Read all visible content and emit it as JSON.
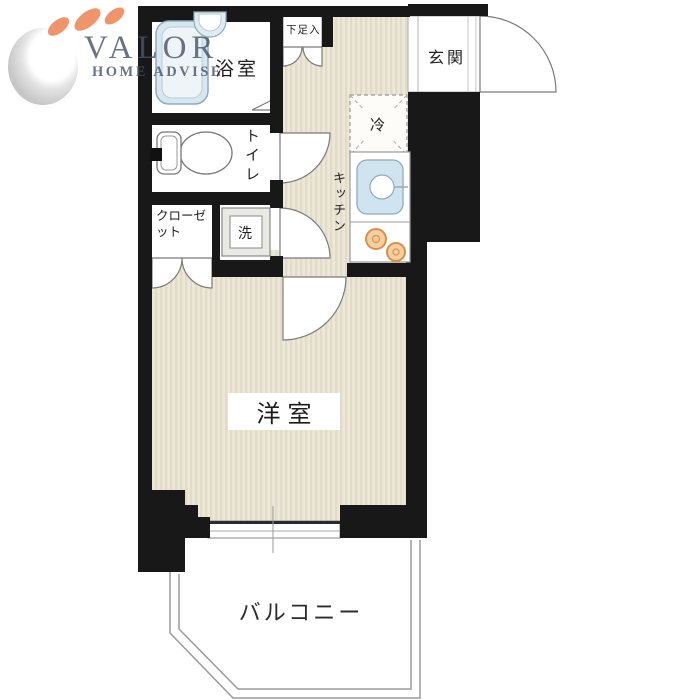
{
  "page": {
    "background": "#ffffff"
  },
  "logo": {
    "title": "VALOR",
    "subtitle": "HOME ADVISE",
    "accent_color": "#ee8b5e",
    "text_color": "#4b5468"
  },
  "floorplan": {
    "wall_color": "#181818",
    "floor_color": "#ece7d7",
    "floor_stripe_color": "#e1dbc8",
    "water_fixture_color": "#cfe4ee",
    "burner_color": "#f6cf9f",
    "labels": {
      "bathroom": "浴室",
      "toilet": "トイレ",
      "closet": "クローゼット",
      "washing_machine": "洗",
      "kitchen": "キッチン",
      "refrigerator": "冷",
      "shoe_cabinet": "下足入",
      "entrance": "玄関",
      "western_room": "洋室",
      "balcony": "バルコニー"
    }
  }
}
